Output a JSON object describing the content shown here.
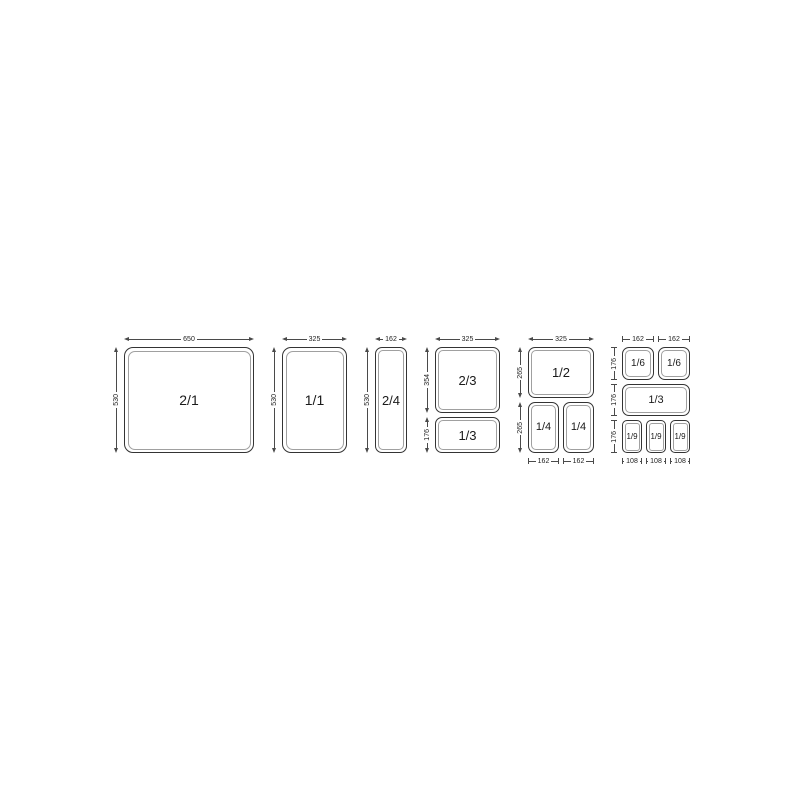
{
  "diagram": {
    "description": "Gastronorm pan size chart",
    "line_color": "#4a4a4a",
    "pan_border_color": "#343434",
    "groups": [
      {
        "top_dims": [
          "650"
        ],
        "side_dims": [
          "530"
        ],
        "rows": [
          [
            "2/1"
          ]
        ]
      },
      {
        "top_dims": [
          "325"
        ],
        "side_dims": [
          "530"
        ],
        "rows": [
          [
            "1/1"
          ]
        ]
      },
      {
        "top_dims": [
          "162"
        ],
        "side_dims": [
          "530"
        ],
        "rows": [
          [
            "2/4"
          ]
        ]
      },
      {
        "top_dims": [
          "325"
        ],
        "side_dims": [
          "354",
          "176"
        ],
        "rows": [
          [
            "2/3"
          ],
          [
            "1/3"
          ]
        ]
      },
      {
        "top_dims": [
          "325"
        ],
        "side_dims": [
          "265",
          "265"
        ],
        "rows": [
          [
            "1/2"
          ],
          [
            "1/4",
            "1/4"
          ]
        ],
        "bottom_dims": [
          "162",
          "162"
        ]
      },
      {
        "top_dims": [
          "162",
          "162"
        ],
        "side_dims": [
          "176",
          "176",
          "176"
        ],
        "rows": [
          [
            "1/6",
            "1/6"
          ],
          [
            "1/3"
          ],
          [
            "1/9",
            "1/9",
            "1/9"
          ]
        ],
        "bottom_dims": [
          "108",
          "108",
          "108"
        ]
      }
    ]
  }
}
